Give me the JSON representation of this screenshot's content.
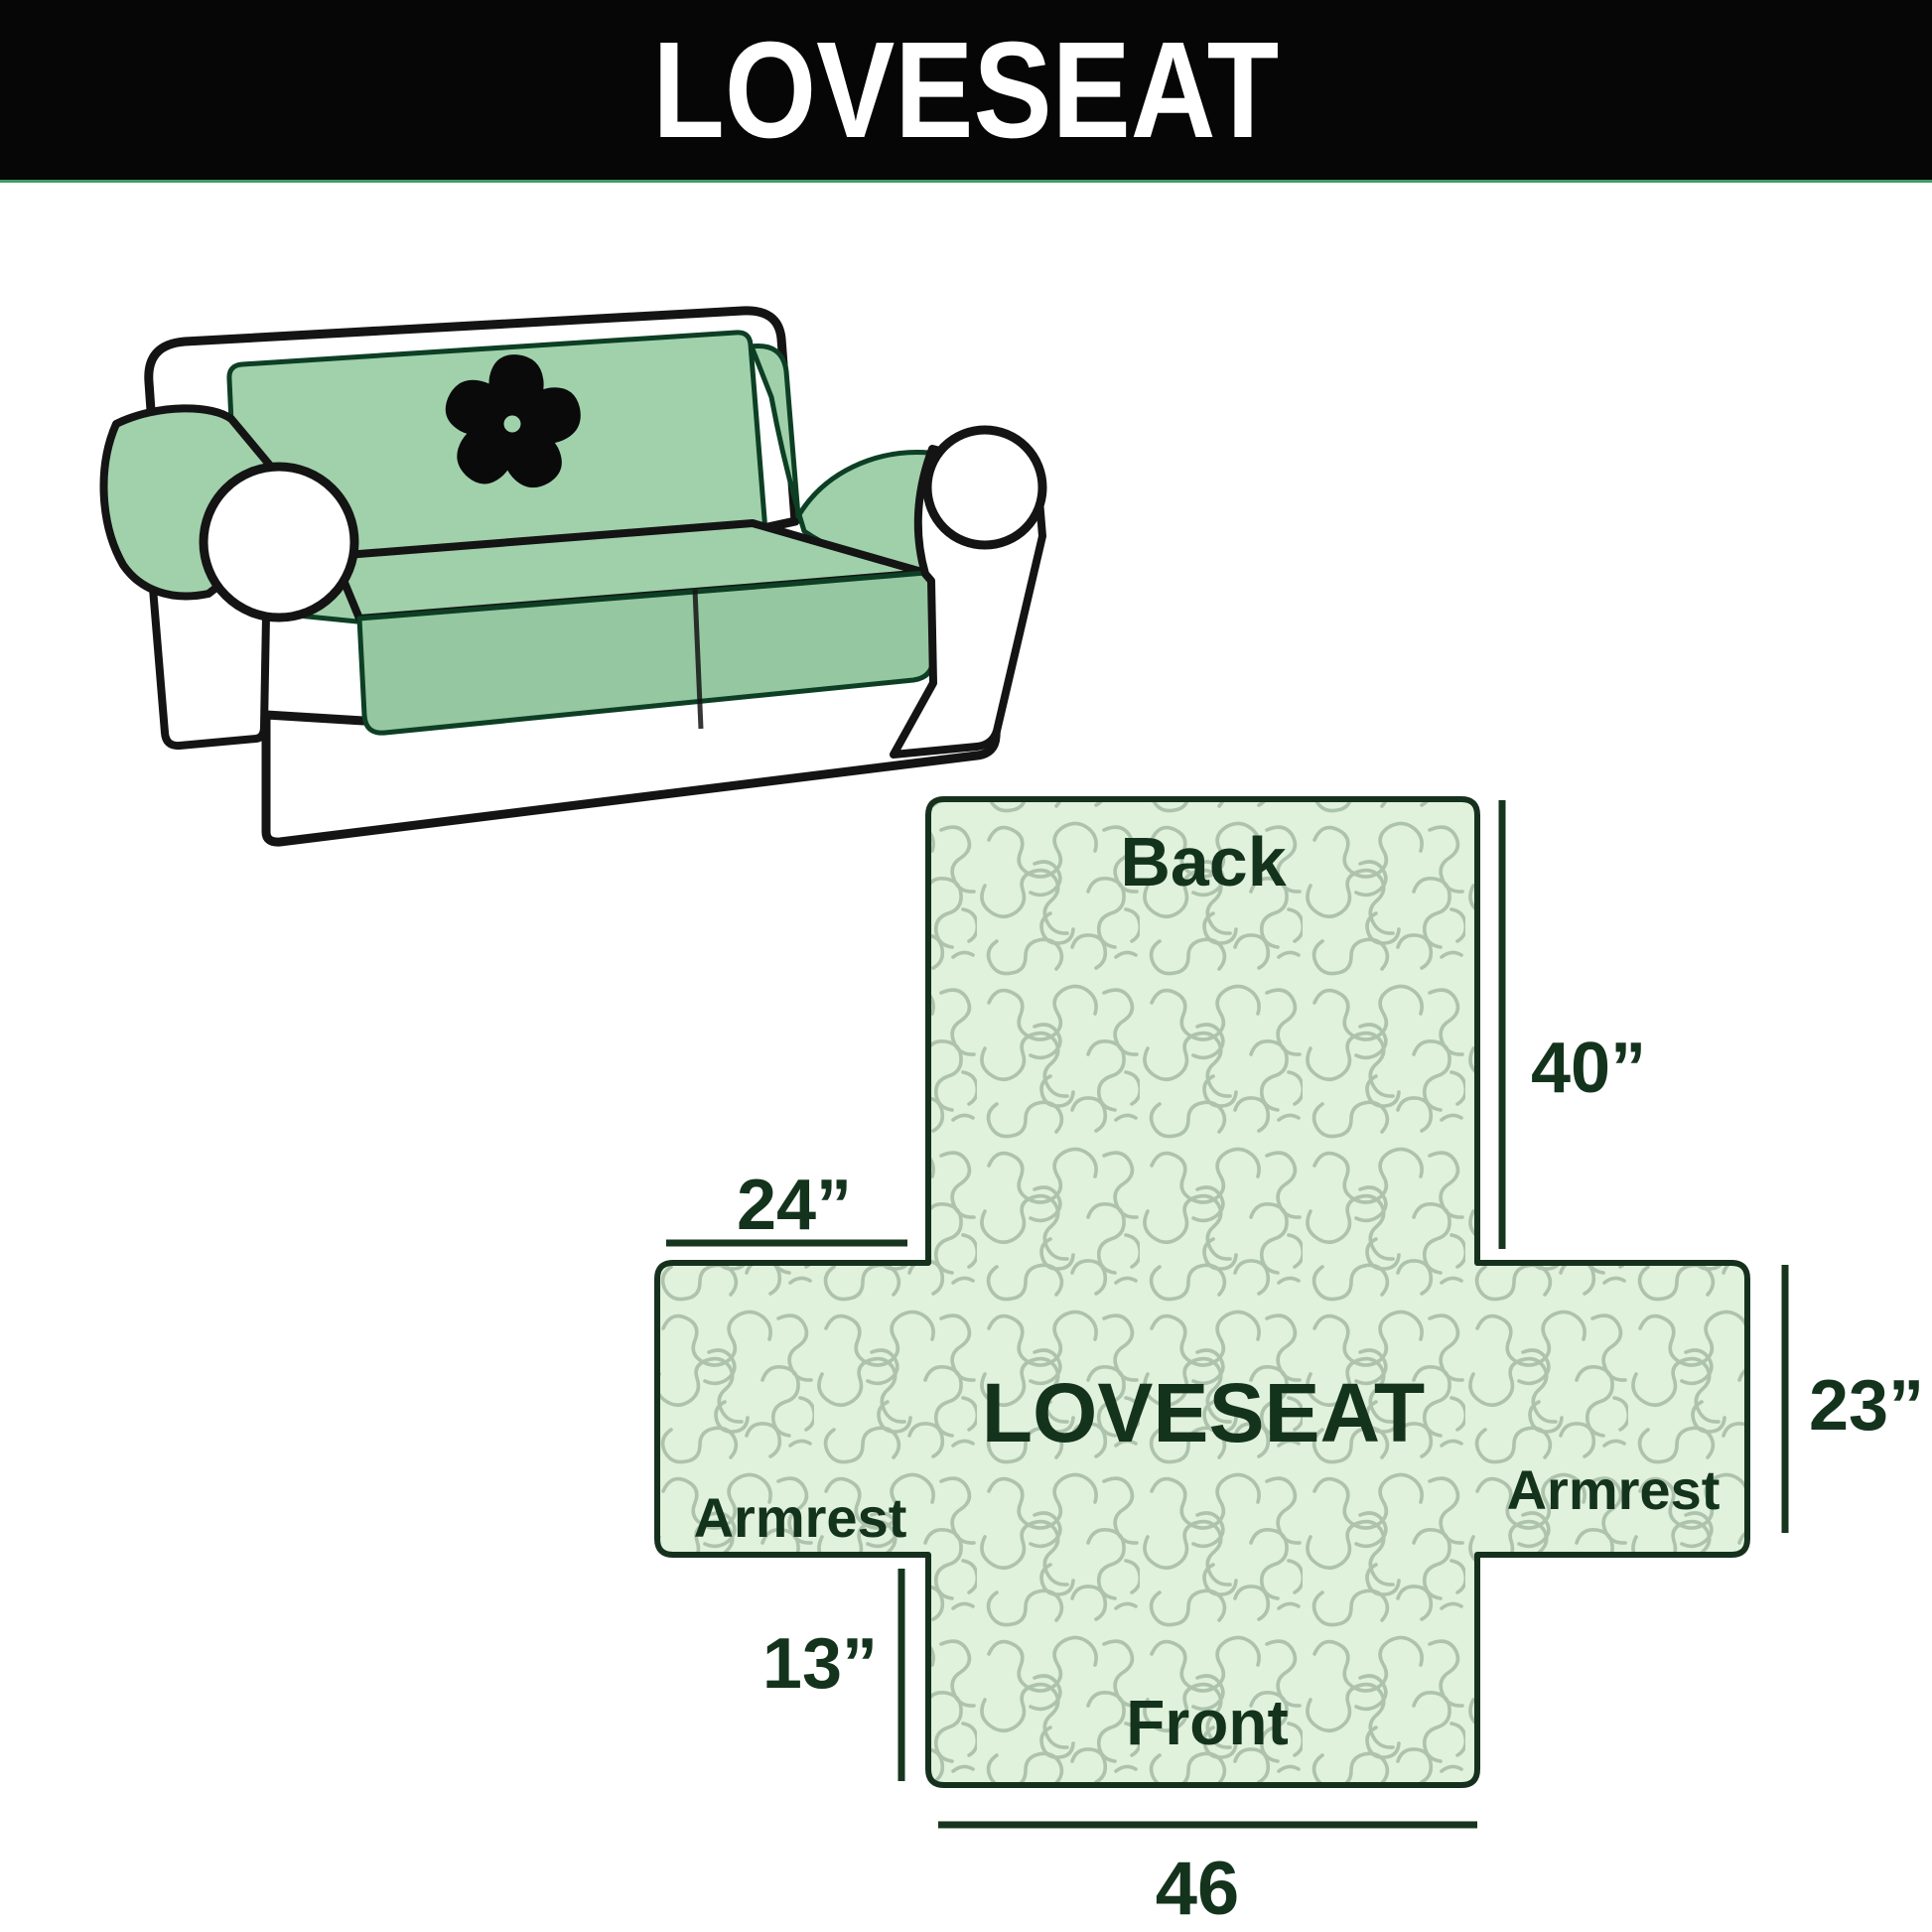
{
  "header": {
    "title": "LOVESEAT"
  },
  "illustration": {
    "alt": "loveseat-sofa-with-quilted-cover",
    "logo": "pinwheel",
    "colors": {
      "cover_green": "#9fd0aa",
      "cover_green_shade": "#95c7a1",
      "cover_edge": "#0d3f24",
      "sofa_outline": "#141414",
      "sofa_body": "#ffffff"
    }
  },
  "diagram": {
    "product_label": "LOVESEAT",
    "sections": {
      "back": "Back",
      "front": "Front",
      "armrest_left": "Armrest",
      "armrest_right": "Armrest"
    },
    "dimensions": {
      "back_height": "40”",
      "armrest_top_width": "24”",
      "armrest_side_height": "23”",
      "front_flap_height": "13”",
      "front_width": "46"
    },
    "colors": {
      "fill": "#e0f1dc",
      "pattern": "#aec3ab",
      "border": "#16301e",
      "text": "#14331d",
      "header_accent": "#3f9c63"
    }
  }
}
